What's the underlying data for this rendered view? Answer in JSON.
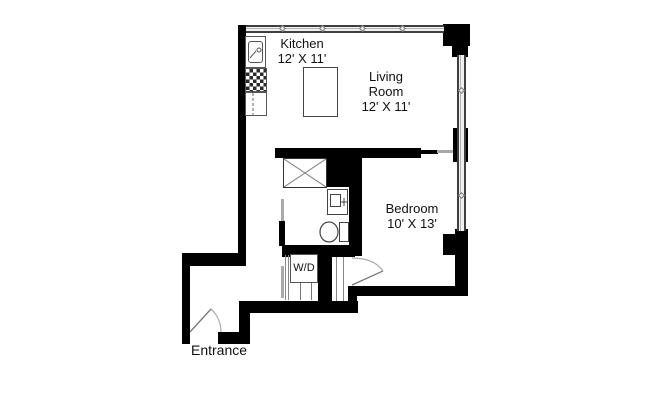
{
  "plan": {
    "type": "apartment-floor-plan",
    "rooms": [
      {
        "id": "kitchen",
        "name": "Kitchen",
        "dimensions": "12' X 11'"
      },
      {
        "id": "living-room",
        "name_line1": "Living",
        "name_line2": "Room",
        "dimensions": "12' X 11'"
      },
      {
        "id": "bedroom",
        "name": "Bedroom",
        "dimensions": "10' X 13'"
      }
    ],
    "labels": {
      "entrance": "Entrance",
      "washer_dryer": "W/D"
    },
    "fixtures": [
      "kitchen-sink",
      "stove",
      "refrigerator",
      "kitchen-island",
      "shower",
      "bathroom-vanity",
      "toilet",
      "washer-dryer"
    ],
    "colors": {
      "wall": "#000000",
      "window_frame": "#3f3f3f",
      "window_fill": "#f0f0f0",
      "fixture_outline": "#555555",
      "door_arc": "#aaaaaa",
      "text": "#111111",
      "background": "#ffffff"
    }
  }
}
